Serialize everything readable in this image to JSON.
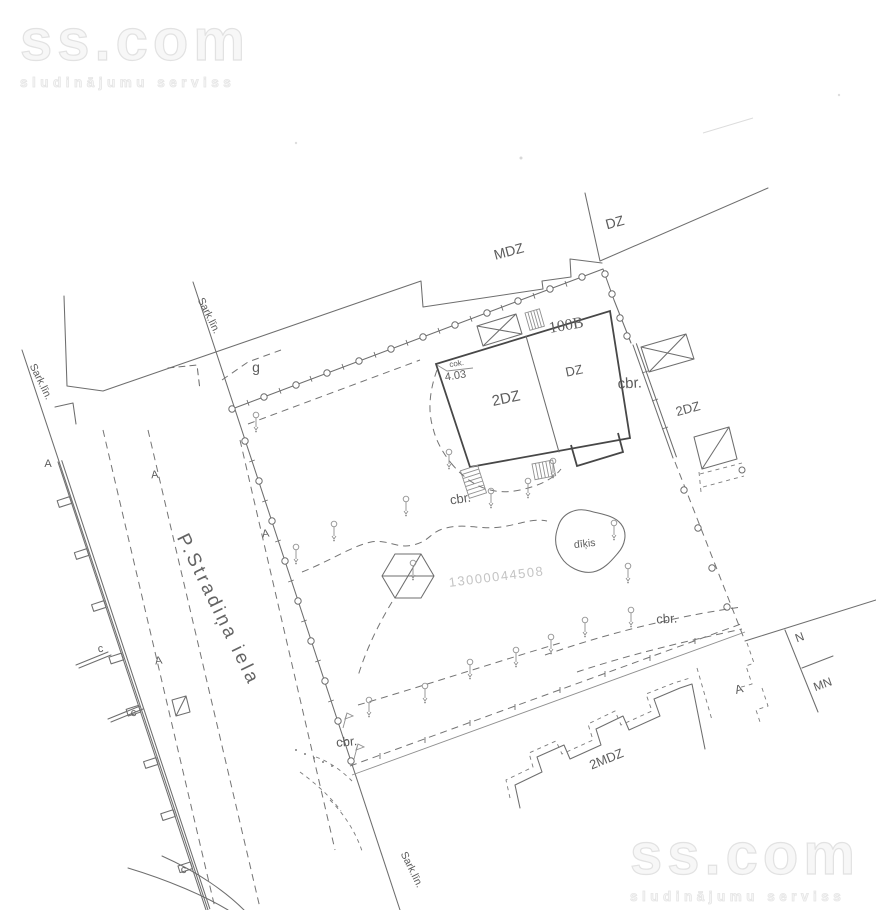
{
  "watermarks": {
    "brand": "ss.com",
    "tagline": "sludinājumu serviss"
  },
  "labels": {
    "street": "P.Stradiņa iela",
    "red_line": "Sark.līn.",
    "cadastral_number": "13000044508",
    "pond": "dīķis",
    "building_mdz": "MDZ",
    "building_dz_top": "DZ",
    "building_number": "100B",
    "room_2dz": "2DZ",
    "room_dz": "DZ",
    "annex_2dz": "2DZ",
    "building_2mdz": "2MDZ",
    "elev_abbr": "cok.",
    "elev_value": "4.03",
    "cbr": "cbr.",
    "g": "g",
    "a": "A",
    "c": "c",
    "n": "N",
    "mn": "MN"
  },
  "colors": {
    "drawing_line": "#6e6e6e",
    "building_line": "#474747",
    "label_text": "#5c5c5c",
    "faint_number": "#c4c4c4",
    "watermark_outline": "#e2e2e2",
    "background": "#ffffff"
  }
}
